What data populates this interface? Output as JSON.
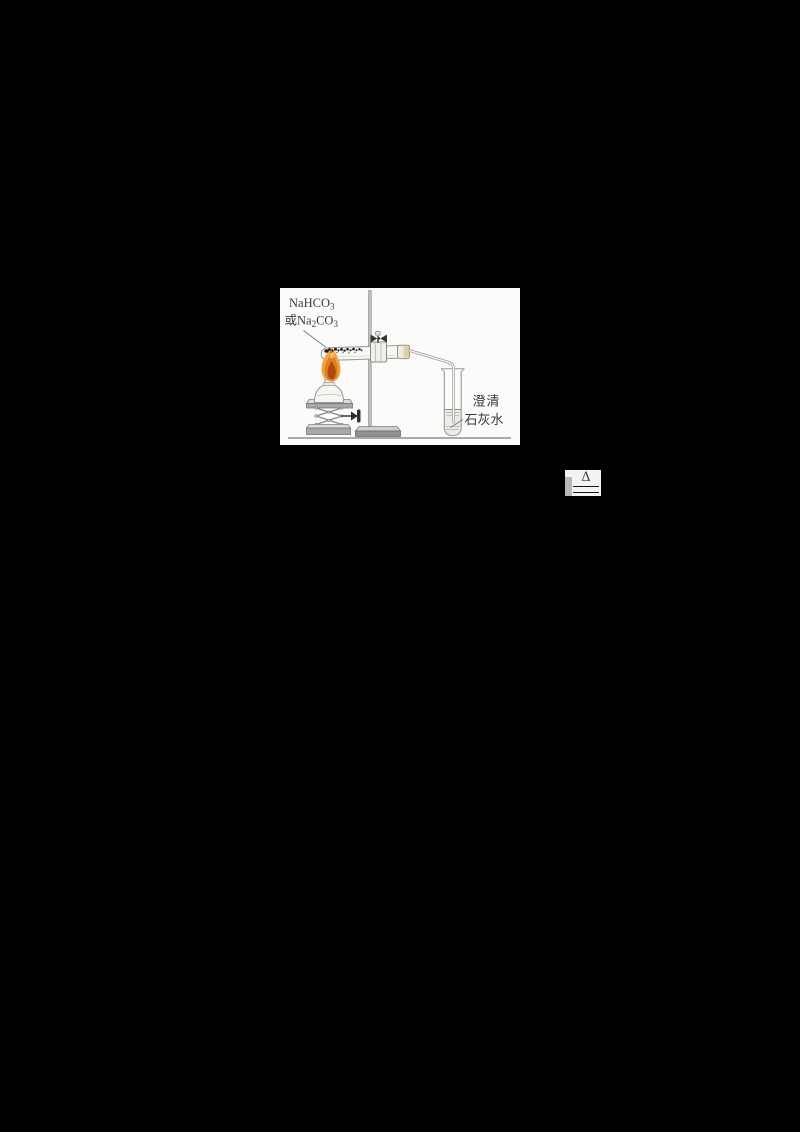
{
  "page": {
    "background": "#000000"
  },
  "figure": {
    "reagent_label": {
      "formula1_base": "NaHCO",
      "formula1_sub": "3",
      "formula2_prefix": "或Na",
      "formula2_sub1": "2",
      "formula2_mid": "CO",
      "formula2_sub2": "3"
    },
    "limewater_label": {
      "line1": "澄清",
      "line2": "石灰水"
    },
    "colors": {
      "figure_background": "#fbfbf9",
      "line_art": "#9a9a9a",
      "flame_outer": "#f1a348",
      "flame_mid": "#e27f22",
      "flame_core": "#ae4a10",
      "flame_tip_highlight": "#f6c463",
      "solid_speckles": "#1f1f1f",
      "stopper_tint": "#d8cd96"
    }
  },
  "equation_fragment": {
    "condition_symbol": "Δ"
  }
}
